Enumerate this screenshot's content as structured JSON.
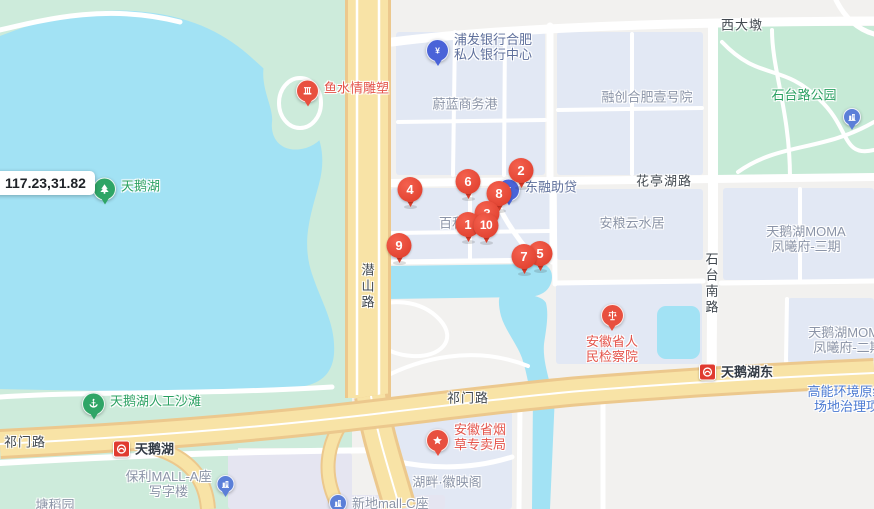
{
  "map": {
    "coordinate_label": "117.23,31.82",
    "colors": {
      "water": "#a2e2f4",
      "green_area": "#cdebdb",
      "park_green": "#c6ead6",
      "building_block": "#e2e8f4",
      "highway_yellow": "#f8e3a6",
      "marker_red": "#dd3a28",
      "metro_red": "#e03b30",
      "poi_pin_blue": "#4a63d8",
      "poi_pin_green": "#2fa566",
      "building_icon_blue": "#5b7fd8"
    },
    "markers": [
      {
        "n": "4",
        "x": 410,
        "y": 208
      },
      {
        "n": "6",
        "x": 468,
        "y": 200
      },
      {
        "n": "2",
        "x": 521,
        "y": 189
      },
      {
        "n": "8",
        "x": 499,
        "y": 212
      },
      {
        "n": "3",
        "x": 487,
        "y": 232
      },
      {
        "n": "9",
        "x": 399,
        "y": 264
      },
      {
        "n": "1",
        "x": 468,
        "y": 243
      },
      {
        "n": "10",
        "x": 486,
        "y": 244
      },
      {
        "n": "5",
        "x": 540,
        "y": 272
      },
      {
        "n": "7",
        "x": 524,
        "y": 275
      }
    ],
    "pois": [
      {
        "id": "pufa-bank-center",
        "icon": "bank",
        "layout": "pin-left",
        "color": "blue",
        "x": 437,
        "y": 47,
        "lines": [
          "浦发银行合肥",
          "私人银行中心"
        ]
      },
      {
        "id": "dongrong-loan",
        "icon": "bank",
        "layout": "pin-left",
        "color": "blue",
        "x": 508,
        "y": 187,
        "lines": [
          "东融助贷"
        ]
      },
      {
        "id": "fish-water-sculpture",
        "icon": "monument",
        "layout": "pin-left",
        "color": "red",
        "x": 307,
        "y": 88,
        "lines": [
          "鱼水情雕塑"
        ]
      },
      {
        "id": "swan-lake",
        "icon": "tree",
        "layout": "pin-left",
        "color": "green",
        "x": 104,
        "y": 186,
        "lines": [
          "天鹅湖"
        ]
      },
      {
        "id": "swan-lake-beach",
        "icon": "beach",
        "layout": "pin-left",
        "color": "green",
        "x": 93,
        "y": 401,
        "lines": [
          "天鹅湖人工沙滩"
        ]
      },
      {
        "id": "shitai-road-park",
        "layout": "text",
        "color": "green",
        "x": 804,
        "y": 95,
        "lines": [
          "石台路公园"
        ]
      },
      {
        "id": "weilan-business-port",
        "layout": "text",
        "color": "gray",
        "x": 465,
        "y": 104,
        "lines": [
          "蔚蓝商务港"
        ]
      },
      {
        "id": "rongchuang-hefei-no1",
        "layout": "text",
        "color": "gray",
        "x": 647,
        "y": 97,
        "lines": [
          "融创合肥壹号院"
        ]
      },
      {
        "id": "anliang-yunshuiju",
        "layout": "text",
        "color": "gray",
        "x": 632,
        "y": 223,
        "lines": [
          "安粮云水居"
        ]
      },
      {
        "id": "swan-lake-moma-phase3",
        "layout": "text",
        "color": "gray",
        "x": 806,
        "y": 239,
        "lines": [
          "天鹅湖MOMA",
          "凤曦府-三期"
        ]
      },
      {
        "id": "swan-lake-moma-phase2",
        "layout": "text",
        "color": "gray",
        "x": 848,
        "y": 340,
        "lines": [
          "天鹅湖MOMA",
          "凤曦府-二期"
        ]
      },
      {
        "id": "baihe",
        "layout": "text",
        "color": "gray",
        "x": 452,
        "y": 223,
        "lines": [
          "百和"
        ]
      },
      {
        "id": "procuratorate",
        "icon": "scales",
        "layout": "pin-top",
        "color": "red",
        "x": 612,
        "y": 315,
        "lines": [
          "安徽省人",
          "民检察院"
        ]
      },
      {
        "id": "tobacco-bureau",
        "icon": "star",
        "layout": "pin-left",
        "color": "red",
        "x": 437,
        "y": 437,
        "lines": [
          "安徽省烟",
          "草专卖局"
        ]
      },
      {
        "id": "metro-swan-lake-east",
        "icon": "metro",
        "layout": "metro",
        "color": "dark",
        "x": 707,
        "y": 372,
        "lines": [
          "天鹅湖东"
        ]
      },
      {
        "id": "metro-swan-lake",
        "icon": "metro",
        "layout": "metro",
        "color": "dark",
        "x": 121,
        "y": 449,
        "lines": [
          "天鹅湖"
        ]
      },
      {
        "id": "baoli-mall-a",
        "icon": "building",
        "layout": "icon-right",
        "color": "gray",
        "x": 180,
        "y": 484,
        "lines": [
          "保利MALL-A座",
          "写字楼"
        ]
      },
      {
        "id": "xindi-mall-c",
        "icon": "building",
        "layout": "icon-left",
        "color": "gray",
        "x": 340,
        "y": 503,
        "lines": [
          "新地mall-C座"
        ]
      },
      {
        "id": "hupan-huiyingge",
        "layout": "text",
        "color": "gray",
        "x": 447,
        "y": 482,
        "lines": [
          "湖畔·徽映阁"
        ]
      },
      {
        "id": "gaoneng-environment-site",
        "layout": "text",
        "color": "construction",
        "x": 853,
        "y": 399,
        "lines": [
          "高能环境原绿地",
          "场地治理项目"
        ]
      },
      {
        "id": "park-facility",
        "icon": "building",
        "layout": "icon-only",
        "color": "gray",
        "x": 852,
        "y": 117,
        "lines": []
      },
      {
        "id": "tangdao",
        "layout": "text",
        "color": "gray",
        "x": 55,
        "y": 505,
        "lines": [
          "塘稻园"
        ]
      }
    ],
    "road_labels": [
      {
        "id": "xidadun",
        "text": "西大墩",
        "x": 742,
        "y": 24,
        "vertical": false
      },
      {
        "id": "huatinghu-road",
        "text": "花亭湖路",
        "x": 664,
        "y": 180,
        "vertical": false
      },
      {
        "id": "qimen-road-west",
        "text": "祁门路",
        "x": 25,
        "y": 441,
        "vertical": false
      },
      {
        "id": "qimen-road-mid",
        "text": "祁门路",
        "x": 468,
        "y": 397,
        "vertical": false
      },
      {
        "id": "qianshan-road",
        "text": "潜山路",
        "x": 367,
        "y": 287,
        "vertical": true
      },
      {
        "id": "shitai-south-road",
        "text": "石台南路",
        "x": 711,
        "y": 284,
        "vertical": true
      }
    ]
  }
}
